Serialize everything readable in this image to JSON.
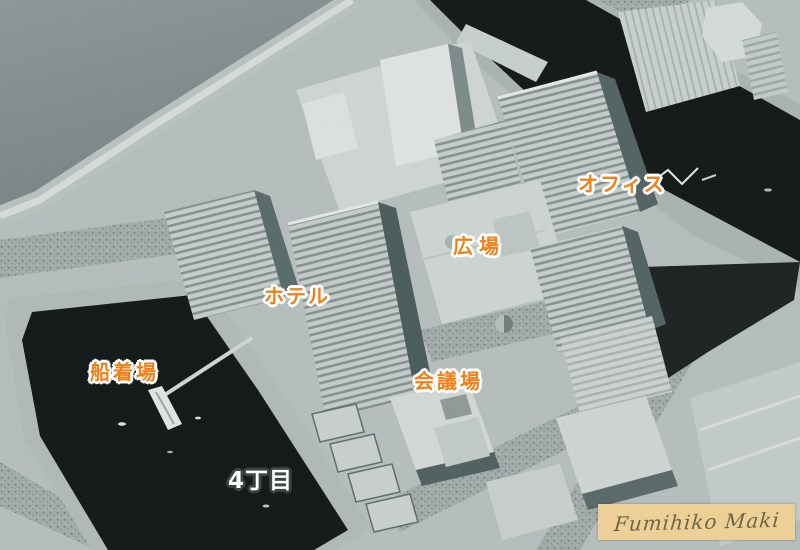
{
  "labels": {
    "office": "オフィス",
    "plaza": "広場",
    "hotel": "ホテル",
    "conference_hall": "会議場",
    "boat_dock": "船着場",
    "district": "4丁目"
  },
  "signature": {
    "name": "Fumihiko Maki"
  },
  "colors": {
    "label_orange": "#f08018",
    "label_outline": "#ffffff",
    "district_white": "#ffffff",
    "district_outline": "#3c4443",
    "signature_bg": "#ecd096",
    "signature_ink": "#6e6547",
    "water_gray": "#7e8a8b",
    "water_dark": "#0d1211",
    "land_light": "#b5bebc",
    "building_bright": "#e0e5e2"
  }
}
